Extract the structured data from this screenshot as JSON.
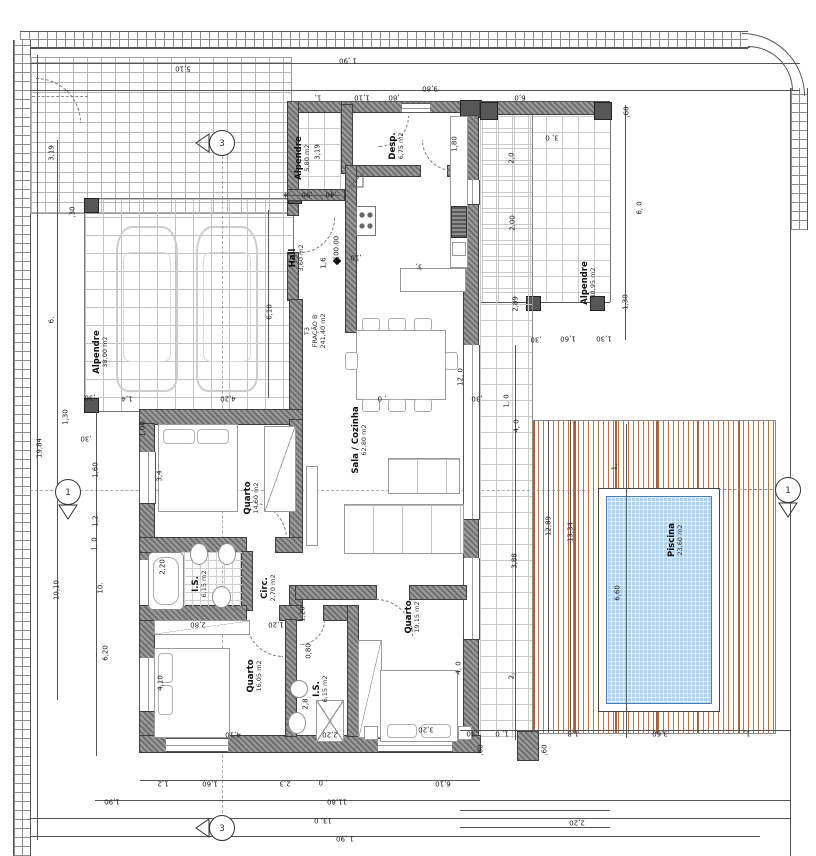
{
  "title": "Planta de arquitetura - Moradia T3 com piscina",
  "unit_info": {
    "fraction": {
      "lines": [
        "T3",
        "FRAÇÃO B",
        "241,40 m2"
      ],
      "x": 315,
      "y": 331
    },
    "level_marker": "100.00"
  },
  "rooms": [
    {
      "name": "Alpendre",
      "area": "5,80 m2",
      "x": 303,
      "y": 158
    },
    {
      "name": "Desp.",
      "area": "6,75 m2",
      "x": 397,
      "y": 146
    },
    {
      "name": "Hall",
      "area": "3,60 m2",
      "x": 297,
      "y": 258
    },
    {
      "name": "Alpendre",
      "area": "38,00 m2",
      "x": 101,
      "y": 352
    },
    {
      "name": "Alpendre",
      "area": "40,95 m2",
      "x": 589,
      "y": 283
    },
    {
      "name": "Sala / Cozinha",
      "area": "62,80 m2",
      "x": 360,
      "y": 440
    },
    {
      "name": "Quarto",
      "area": "14,60 m2",
      "x": 252,
      "y": 498
    },
    {
      "name": "I.S.",
      "area": "6,15 m2",
      "x": 200,
      "y": 584
    },
    {
      "name": "Circ.",
      "area": "2,70 m2",
      "x": 269,
      "y": 588
    },
    {
      "name": "Quarto",
      "area": "16,05 m2",
      "x": 255,
      "y": 676
    },
    {
      "name": "I.S.",
      "area": "6,15 m2",
      "x": 321,
      "y": 689
    },
    {
      "name": "Quarto",
      "area": "19,15 m2",
      "x": 413,
      "y": 617
    },
    {
      "name": "Piscina",
      "area": "23,60 m2",
      "x": 676,
      "y": 540
    }
  ],
  "section_markers": [
    {
      "id": "top",
      "label": "3"
    },
    {
      "id": "bottom",
      "label": "3"
    },
    {
      "id": "left",
      "label": "1"
    },
    {
      "id": "right",
      "label": "1"
    }
  ],
  "dims": [
    {
      "t": "5,10",
      "x": 183,
      "y": 68,
      "r": 180
    },
    {
      "t": "1 ,90",
      "x": 348,
      "y": 60,
      "r": 180
    },
    {
      "t": "9,80",
      "x": 430,
      "y": 88,
      "r": 180
    },
    {
      "t": "1,",
      "x": 318,
      "y": 97,
      "r": 180
    },
    {
      "t": "1,10",
      "x": 362,
      "y": 97,
      "r": 180
    },
    {
      "t": ",80",
      "x": 394,
      "y": 97,
      "r": 180
    },
    {
      "t": "6,0",
      "x": 520,
      "y": 97,
      "r": 180
    },
    {
      "t": "3, 0",
      "x": 552,
      "y": 137,
      "r": 180
    },
    {
      "t": ",60",
      "x": 627,
      "y": 112,
      "r": 90
    },
    {
      "t": "1,80",
      "x": 455,
      "y": 144,
      "r": 90
    },
    {
      "t": "2,0",
      "x": 512,
      "y": 158,
      "r": 90
    },
    {
      "t": "2,00",
      "x": 513,
      "y": 223,
      "r": 90
    },
    {
      "t": "6, 0",
      "x": 640,
      "y": 208,
      "r": 90
    },
    {
      "t": "2,89",
      "x": 516,
      "y": 304,
      "r": 90
    },
    {
      "t": "1,30",
      "x": 626,
      "y": 302,
      "r": 90
    },
    {
      "t": ",30",
      "x": 536,
      "y": 339,
      "r": 180
    },
    {
      "t": "1,60",
      "x": 568,
      "y": 338,
      "r": 180
    },
    {
      "t": "1,30",
      "x": 604,
      "y": 338,
      "r": 180
    },
    {
      "t": ",30",
      "x": 73,
      "y": 212,
      "r": 90
    },
    {
      "t": "6,10",
      "x": 270,
      "y": 312,
      "r": 90
    },
    {
      "t": ",30",
      "x": 90,
      "y": 397,
      "r": 180
    },
    {
      "t": "1,4",
      "x": 127,
      "y": 398,
      "r": 180
    },
    {
      "t": "4,20",
      "x": 228,
      "y": 398,
      "r": 180
    },
    {
      "t": "3,19",
      "x": 52,
      "y": 153,
      "r": 90
    },
    {
      "t": "3,19",
      "x": 318,
      "y": 152,
      "r": 90
    },
    {
      "t": "6,",
      "x": 52,
      "y": 320,
      "r": 90
    },
    {
      "t": "19,84",
      "x": 40,
      "y": 448,
      "r": 90
    },
    {
      "t": "1,30",
      "x": 66,
      "y": 417,
      "r": 90
    },
    {
      "t": ",30",
      "x": 86,
      "y": 438,
      "r": 180
    },
    {
      "t": "1,00",
      "x": 143,
      "y": 429,
      "r": 90
    },
    {
      "t": "1,60",
      "x": 96,
      "y": 470,
      "r": 90
    },
    {
      "t": "1,2",
      "x": 96,
      "y": 521,
      "r": 90
    },
    {
      "t": "1, 0",
      "x": 95,
      "y": 544,
      "r": 90
    },
    {
      "t": "10,10",
      "x": 57,
      "y": 590,
      "r": 90
    },
    {
      "t": "10.",
      "x": 101,
      "y": 588,
      "r": 90
    },
    {
      "t": "6,20",
      "x": 106,
      "y": 653,
      "r": 90
    },
    {
      "t": "3,4",
      "x": 160,
      "y": 476,
      "r": 90
    },
    {
      "t": "2,20",
      "x": 163,
      "y": 567,
      "r": 90
    },
    {
      "t": ",4",
      "x": 287,
      "y": 194,
      "r": 180
    },
    {
      "t": ",90",
      "x": 307,
      "y": 194,
      "r": 180
    },
    {
      "t": ",40",
      "x": 331,
      "y": 194,
      "r": 180
    },
    {
      "t": "1,6",
      "x": 324,
      "y": 263,
      "r": 90
    },
    {
      "t": "100.00",
      "x": 337,
      "y": 248,
      "r": 90
    },
    {
      "t": ",10",
      "x": 356,
      "y": 257,
      "r": 180
    },
    {
      "t": "3,",
      "x": 419,
      "y": 266,
      "r": 180
    },
    {
      "t": "12, 0",
      "x": 461,
      "y": 377,
      "r": 90
    },
    {
      "t": ", 0",
      "x": 382,
      "y": 398,
      "r": 180
    },
    {
      "t": ",30",
      "x": 477,
      "y": 398,
      "r": 180
    },
    {
      "t": "1, 0",
      "x": 507,
      "y": 401,
      "r": 90
    },
    {
      "t": "4, 0",
      "x": 517,
      "y": 426,
      "r": 90
    },
    {
      "t": "3,88",
      "x": 515,
      "y": 561,
      "r": 90
    },
    {
      "t": "2,",
      "x": 512,
      "y": 676,
      "r": 90
    },
    {
      "t": "1,",
      "x": 615,
      "y": 467,
      "r": 90
    },
    {
      "t": "12,89",
      "x": 549,
      "y": 526,
      "r": 90
    },
    {
      "t": "13,34",
      "x": 571,
      "y": 532,
      "r": 90
    },
    {
      "t": "6,60",
      "x": 618,
      "y": 593,
      "r": 90
    },
    {
      "t": ",30",
      "x": 472,
      "y": 733,
      "r": 180
    },
    {
      "t": "1, 0",
      "x": 502,
      "y": 733,
      "r": 180
    },
    {
      "t": "1,8",
      "x": 573,
      "y": 733,
      "r": 180
    },
    {
      "t": "3,60",
      "x": 660,
      "y": 733,
      "r": 180
    },
    {
      "t": "1,",
      "x": 747,
      "y": 733,
      "r": 180
    },
    {
      "t": ",60",
      "x": 481,
      "y": 750,
      "r": 90
    },
    {
      "t": ",60",
      "x": 545,
      "y": 750,
      "r": 90
    },
    {
      "t": "2,20",
      "x": 577,
      "y": 822,
      "r": 180
    },
    {
      "t": "2,80",
      "x": 198,
      "y": 624,
      "r": 180
    },
    {
      "t": "1,20",
      "x": 276,
      "y": 624,
      "r": 180
    },
    {
      "t": "1,20",
      "x": 303,
      "y": 614,
      "r": 90
    },
    {
      "t": "0,80",
      "x": 309,
      "y": 651,
      "r": 90
    },
    {
      "t": "4,10",
      "x": 161,
      "y": 683,
      "r": 90
    },
    {
      "t": "4,10",
      "x": 233,
      "y": 734,
      "r": 180
    },
    {
      "t": "2,8",
      "x": 306,
      "y": 704,
      "r": 90
    },
    {
      "t": "2,20",
      "x": 330,
      "y": 734,
      "r": 180
    },
    {
      "t": "3,20",
      "x": 426,
      "y": 729,
      "r": 180
    },
    {
      "t": "4, 0",
      "x": 459,
      "y": 668,
      "r": 90
    },
    {
      "t": "1,2",
      "x": 163,
      "y": 783,
      "r": 180
    },
    {
      "t": "1,60",
      "x": 210,
      "y": 783,
      "r": 180
    },
    {
      "t": "2,3",
      "x": 285,
      "y": 783,
      "r": 180
    },
    {
      "t": ", 0",
      "x": 323,
      "y": 782,
      "r": 180
    },
    {
      "t": "6,10",
      "x": 443,
      "y": 783,
      "r": 180
    },
    {
      "t": "1,90",
      "x": 112,
      "y": 801,
      "r": 180
    },
    {
      "t": "11,80",
      "x": 337,
      "y": 801,
      "r": 180
    },
    {
      "t": "13, 0",
      "x": 323,
      "y": 820,
      "r": 180
    },
    {
      "t": "1 ,90",
      "x": 345,
      "y": 838,
      "r": 180
    }
  ],
  "colors": {
    "wall": "#6f6f6f",
    "pool_water": "#a9d2f3",
    "deck_stripe": "#b26434",
    "tile_line": "#c2c2c2",
    "text": "#1a1a1a"
  }
}
